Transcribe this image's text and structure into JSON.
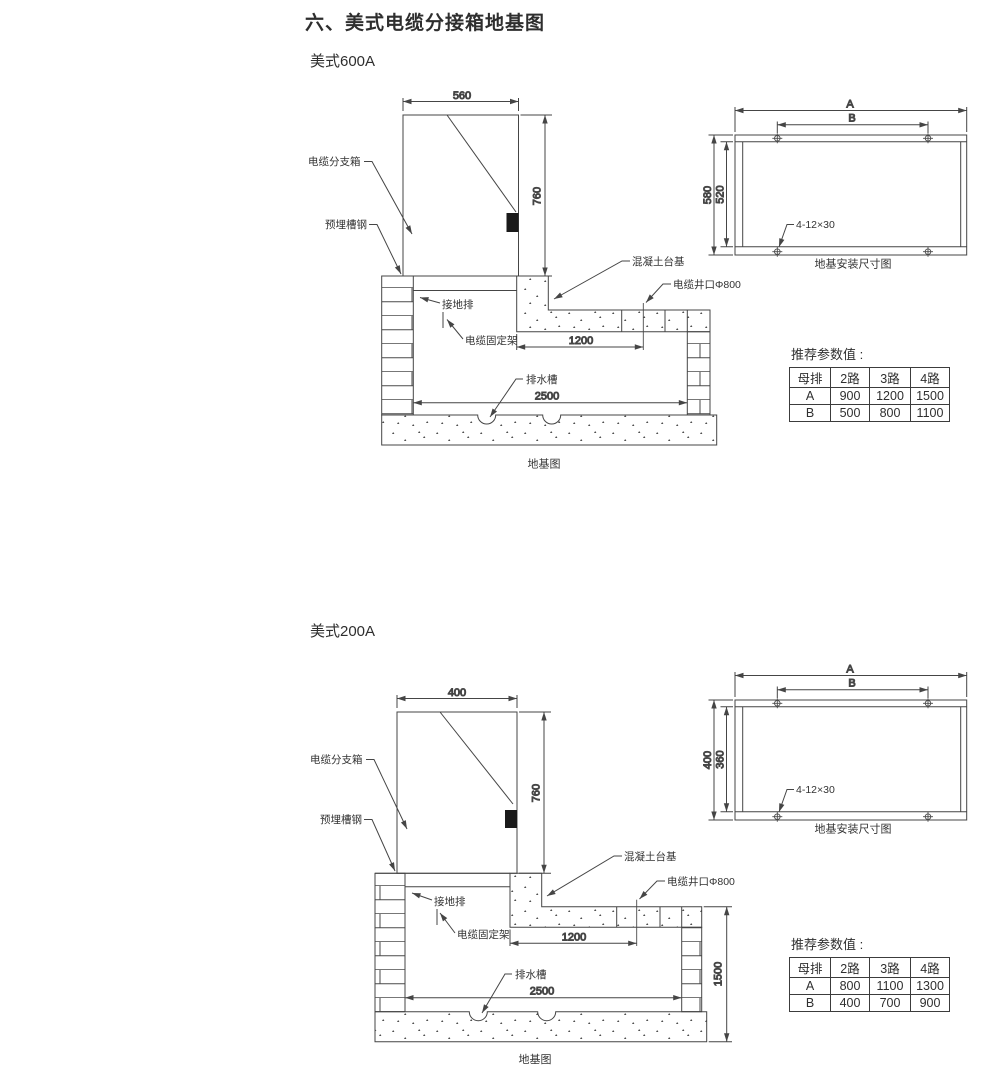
{
  "page": {
    "title": "六、美式电缆分接箱地基图"
  },
  "sections": [
    {
      "title": "美式600A",
      "side_view": {
        "caption": "地基图",
        "labels": {
          "cabinet": "电缆分支箱",
          "embedded_channel": "预埋槽钢",
          "grounding_bar": "接地排",
          "cable_bracket": "电缆固定架",
          "concrete_base": "混凝土台基",
          "cable_well": "电缆井口Φ800",
          "drain": "排水槽"
        },
        "dims": {
          "width": "560",
          "height": "760",
          "platform": "1200",
          "base": "2500"
        }
      },
      "plan_view": {
        "caption": "地基安装尺寸图",
        "dims": {
          "a": "A",
          "b": "B",
          "outer": "580",
          "inner": "520",
          "bolts": "4-12×30"
        }
      },
      "params": {
        "title": "推荐参数值 :",
        "headers": [
          "母排",
          "2路",
          "3路",
          "4路"
        ],
        "rows": [
          [
            "A",
            "900",
            "1200",
            "1500"
          ],
          [
            "B",
            "500",
            "800",
            "1100"
          ]
        ]
      }
    },
    {
      "title": "美式200A",
      "side_view": {
        "caption": "地基图",
        "labels": {
          "cabinet": "电缆分支箱",
          "embedded_channel": "预埋槽钢",
          "grounding_bar": "接地排",
          "cable_bracket": "电缆固定架",
          "concrete_base": "混凝土台基",
          "cable_well": "电缆井口Φ800",
          "drain": "排水槽"
        },
        "dims": {
          "width": "400",
          "height": "760",
          "platform": "1200",
          "base": "2500",
          "depth": "1500"
        }
      },
      "plan_view": {
        "caption": "地基安装尺寸图",
        "dims": {
          "a": "A",
          "b": "B",
          "outer": "400",
          "inner": "360",
          "bolts": "4-12×30"
        }
      },
      "params": {
        "title": "推荐参数值 :",
        "headers": [
          "母排",
          "2路",
          "3路",
          "4路"
        ],
        "rows": [
          [
            "A",
            "800",
            "1100",
            "1300"
          ],
          [
            "B",
            "400",
            "700",
            "900"
          ]
        ]
      }
    }
  ]
}
